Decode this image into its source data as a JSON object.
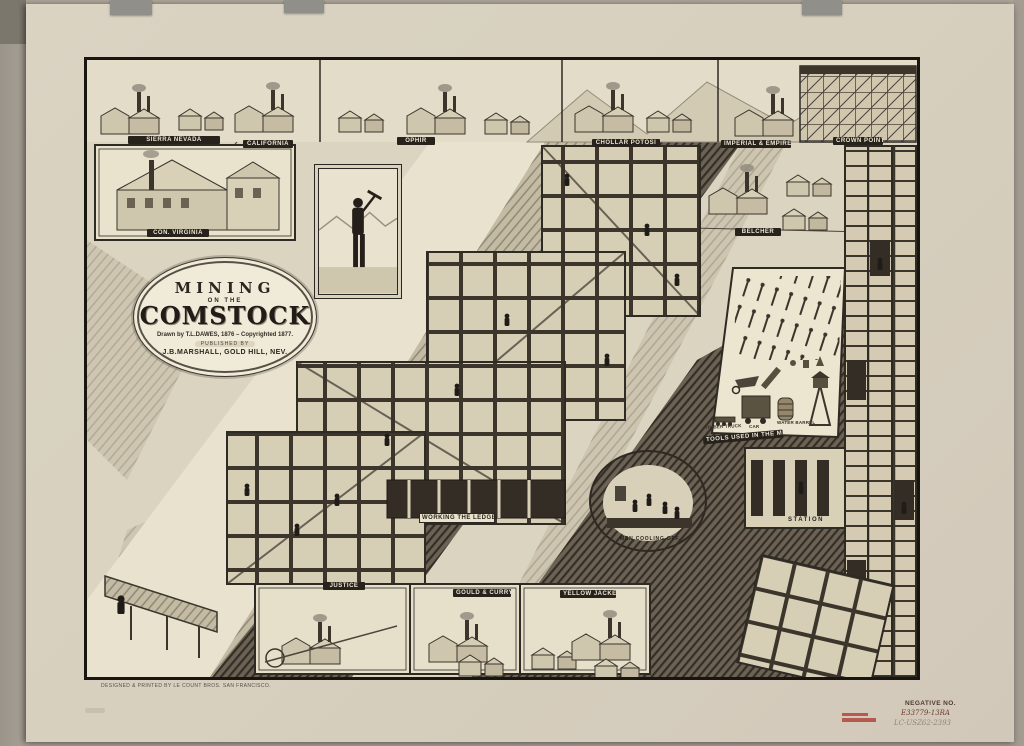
{
  "artwork": {
    "title": {
      "line1": "MINING",
      "line2": "ON THE",
      "line3": "COMSTOCK",
      "credit": "Drawn by T.L.DAWES, 1876 – Copyrighted 1877.",
      "published_by": "PUBLISHED BY",
      "publisher": "J.B.MARSHALL, GOLD HILL, NEV."
    },
    "imprint": "DESIGNED & PRINTED BY LE COUNT BROS. SAN FRANCISCO.",
    "vignette_labels": {
      "top_row": [
        "SIERRA NEVADA",
        "CALIFORNIA",
        "OPHIR",
        "CHOLLAR POTOSI",
        "IMPERIAL & EMPIRE",
        "CROWN POINT"
      ],
      "left_mill": "CON. VIRGINIA",
      "right_works": "BELCHER",
      "bottom_row": [
        "JUSTICE",
        "GOULD & CURRY",
        "YELLOW JACKET"
      ]
    },
    "scene_labels": {
      "working_the_ledge": "WORKING THE LEDGE",
      "men_cooling_off": "MEN COOLING OFF.",
      "station": "STATION"
    },
    "tools_panel": {
      "caption": "TOOLS USED IN THE MINES",
      "item_labels": [
        "TIMBER TRUCK",
        "CAR",
        "WATER BARREL"
      ]
    },
    "colors": {
      "paper": "#d8d1bf",
      "ink": "#2b2620",
      "scan_bed": "#aca69a",
      "stamp_red": "#b0453c"
    }
  },
  "scan_annotations": {
    "negative_label": "NEGATIVE NO.",
    "negative_number": "E33779-13RA",
    "catalog_number": "LC-USZ62-2393"
  }
}
